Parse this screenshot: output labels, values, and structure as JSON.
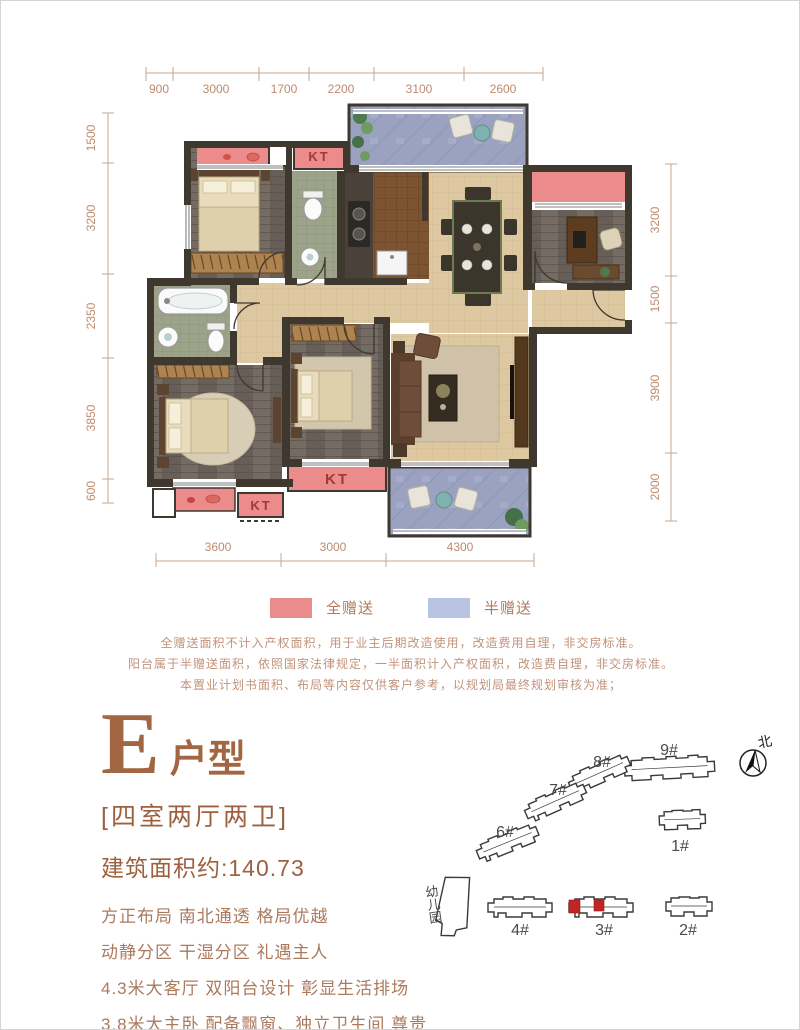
{
  "floorplan": {
    "dims_top": [
      "900",
      "3000",
      "1700",
      "2200",
      "3100",
      "2600"
    ],
    "dims_left": [
      "1500",
      "3200",
      "2350",
      "3850",
      "600"
    ],
    "dims_right": [
      "3200",
      "1500",
      "3900",
      "2000"
    ],
    "dims_bottom": [
      "3600",
      "3000",
      "4300"
    ],
    "kt_label": "KT",
    "colors": {
      "full_gift": "#ec8b8b",
      "half_gift": "#b7c5e2",
      "wall": "#3f382f"
    }
  },
  "legend": {
    "full_gift": "全赠送",
    "half_gift": "半赠送"
  },
  "disclaimer": [
    "全赠送面积不计入产权面积，用于业主后期改造使用，改造费用自理，非交房标准。",
    "阳台属于半赠送面积，依照国家法律规定，一半面积计入产权面积，改造费自理，非交房标准。",
    "本置业计划书面积、布局等内容仅供客户参考，以规划局最终规划审核为准；"
  ],
  "unit": {
    "letter": "E",
    "suffix": "户型",
    "rooms": "[四室两厅两卫]",
    "area": "建筑面积约:140.73",
    "features": [
      "方正布局 南北通透 格局优越",
      "动静分区 干湿分区 礼遇主人",
      "4.3米大客厅 双阳台设计 彰显生活排场",
      "3.8米大主卧 配备飘窗、独立卫生间 尊贵罕有"
    ]
  },
  "siteplan": {
    "north": "北",
    "kindergarten": "幼儿园",
    "buildings": [
      "1#",
      "2#",
      "3#",
      "4#",
      "6#",
      "7#",
      "8#",
      "9#"
    ],
    "highlighted": "3#",
    "highlight_color": "#c32524"
  }
}
